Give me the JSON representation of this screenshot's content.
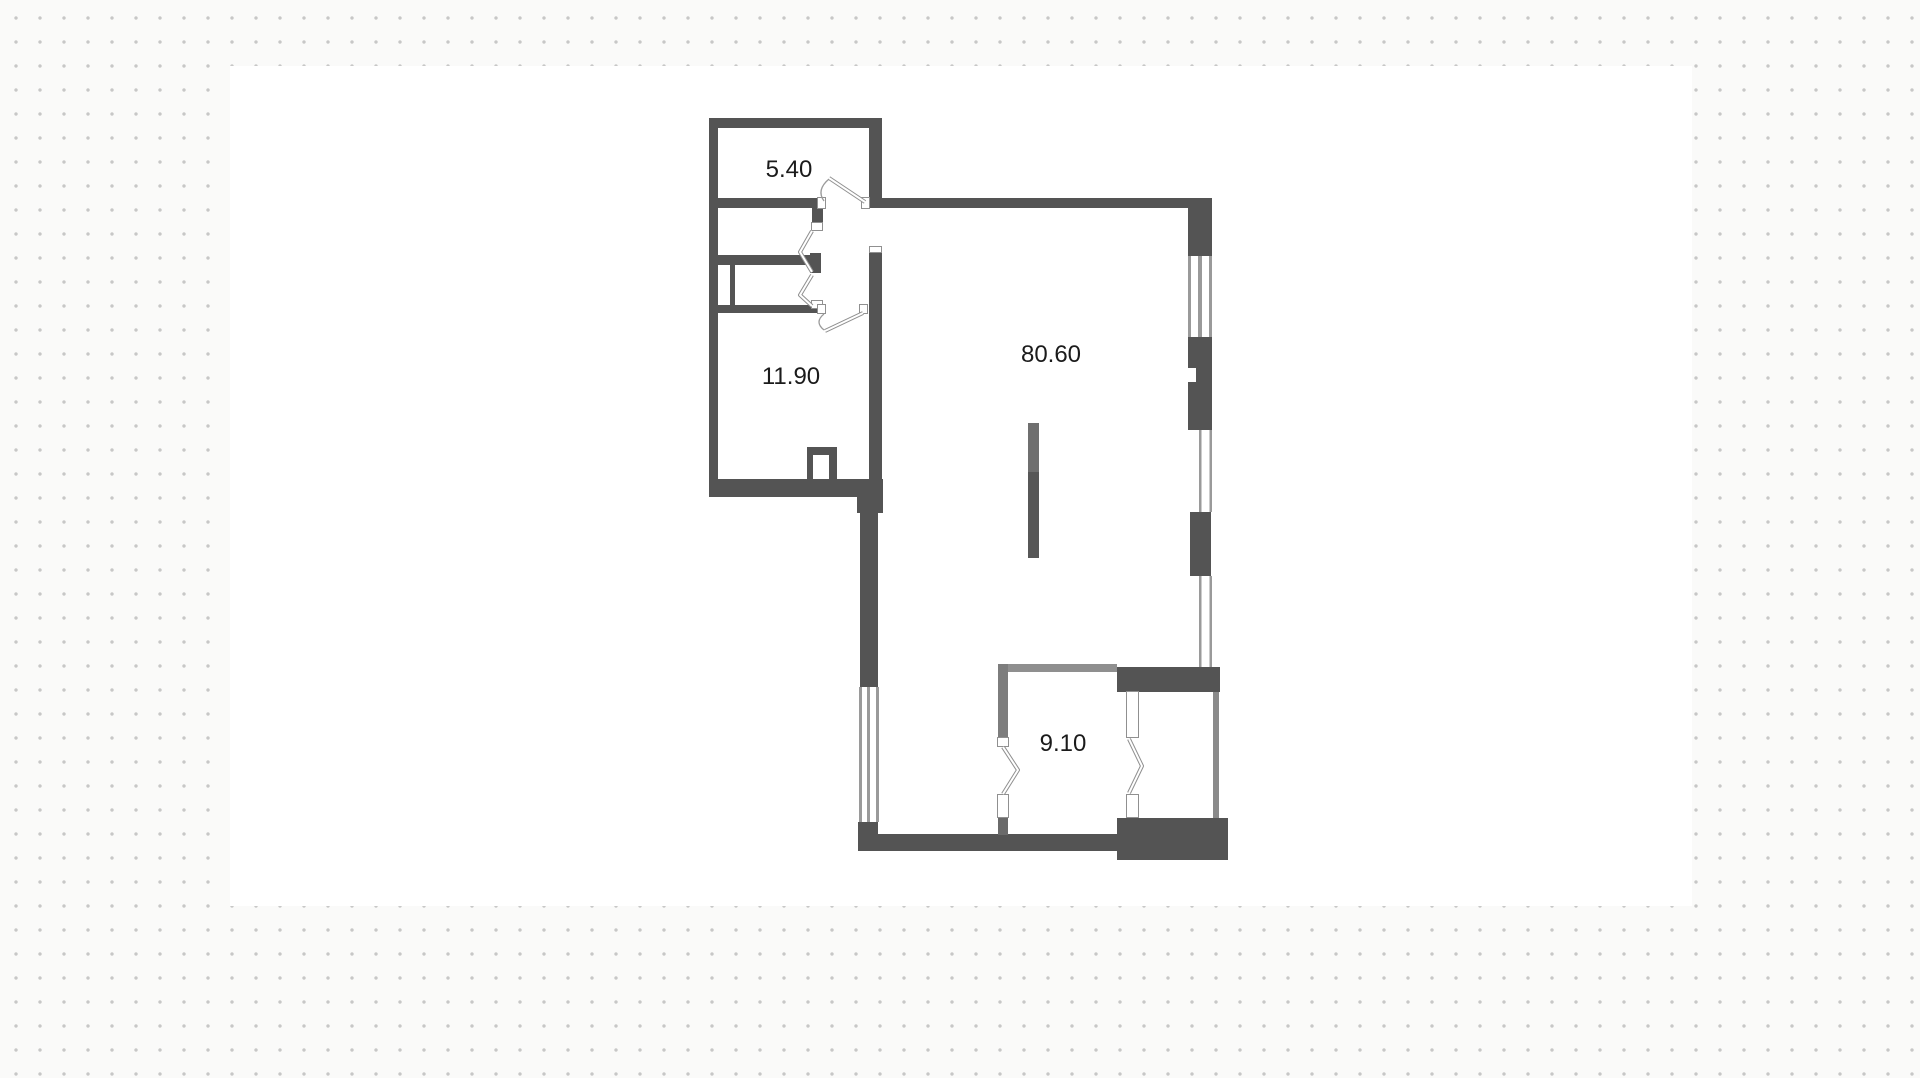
{
  "plan": {
    "title": "apartment-floor-plan",
    "rooms": [
      {
        "name": "top-small-room",
        "label": "5.40"
      },
      {
        "name": "left-room",
        "label": "11.90"
      },
      {
        "name": "main-room",
        "label": "80.60"
      },
      {
        "name": "bottom-room",
        "label": "9.10"
      }
    ],
    "symbols": [
      "door-swing-icon",
      "folding-door-icon",
      "window-symbol",
      "vent-shaft-symbol",
      "built-in-cabinet"
    ],
    "colors": {
      "wall": "#545454",
      "wall_light": "#8a8a8a",
      "window_line": "#9a9a9a",
      "door_outline": "#8f8f8f",
      "label_text": "#1b1b1b",
      "dot": "#c7c7c7",
      "canvas": "#ffffff",
      "page_bg": "#fafaf9"
    }
  }
}
